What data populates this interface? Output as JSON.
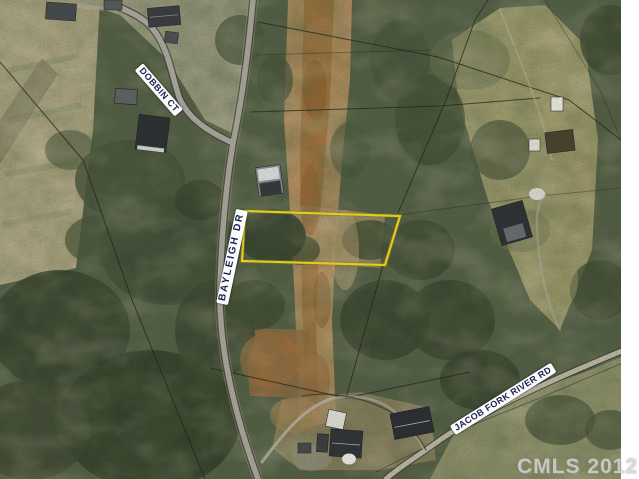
{
  "map": {
    "kind": "aerial-parcel-photo",
    "road_labels": [
      {
        "name": "dobbin-ct",
        "text": "DOBBIN CT"
      },
      {
        "name": "bayleigh-dr",
        "text": "BAYLEIGH DR"
      },
      {
        "name": "jacob-fork-river-rd",
        "text": "JACOB FORK RIVER RD"
      }
    ],
    "watermark": "CMLS 2012",
    "highlight": {
      "type": "parcel-outline",
      "color": "#e6d026"
    },
    "colors": {
      "label_text": "#1a2150",
      "label_bg": "#fcfcfc",
      "watermark": "#d3d3d3"
    }
  }
}
